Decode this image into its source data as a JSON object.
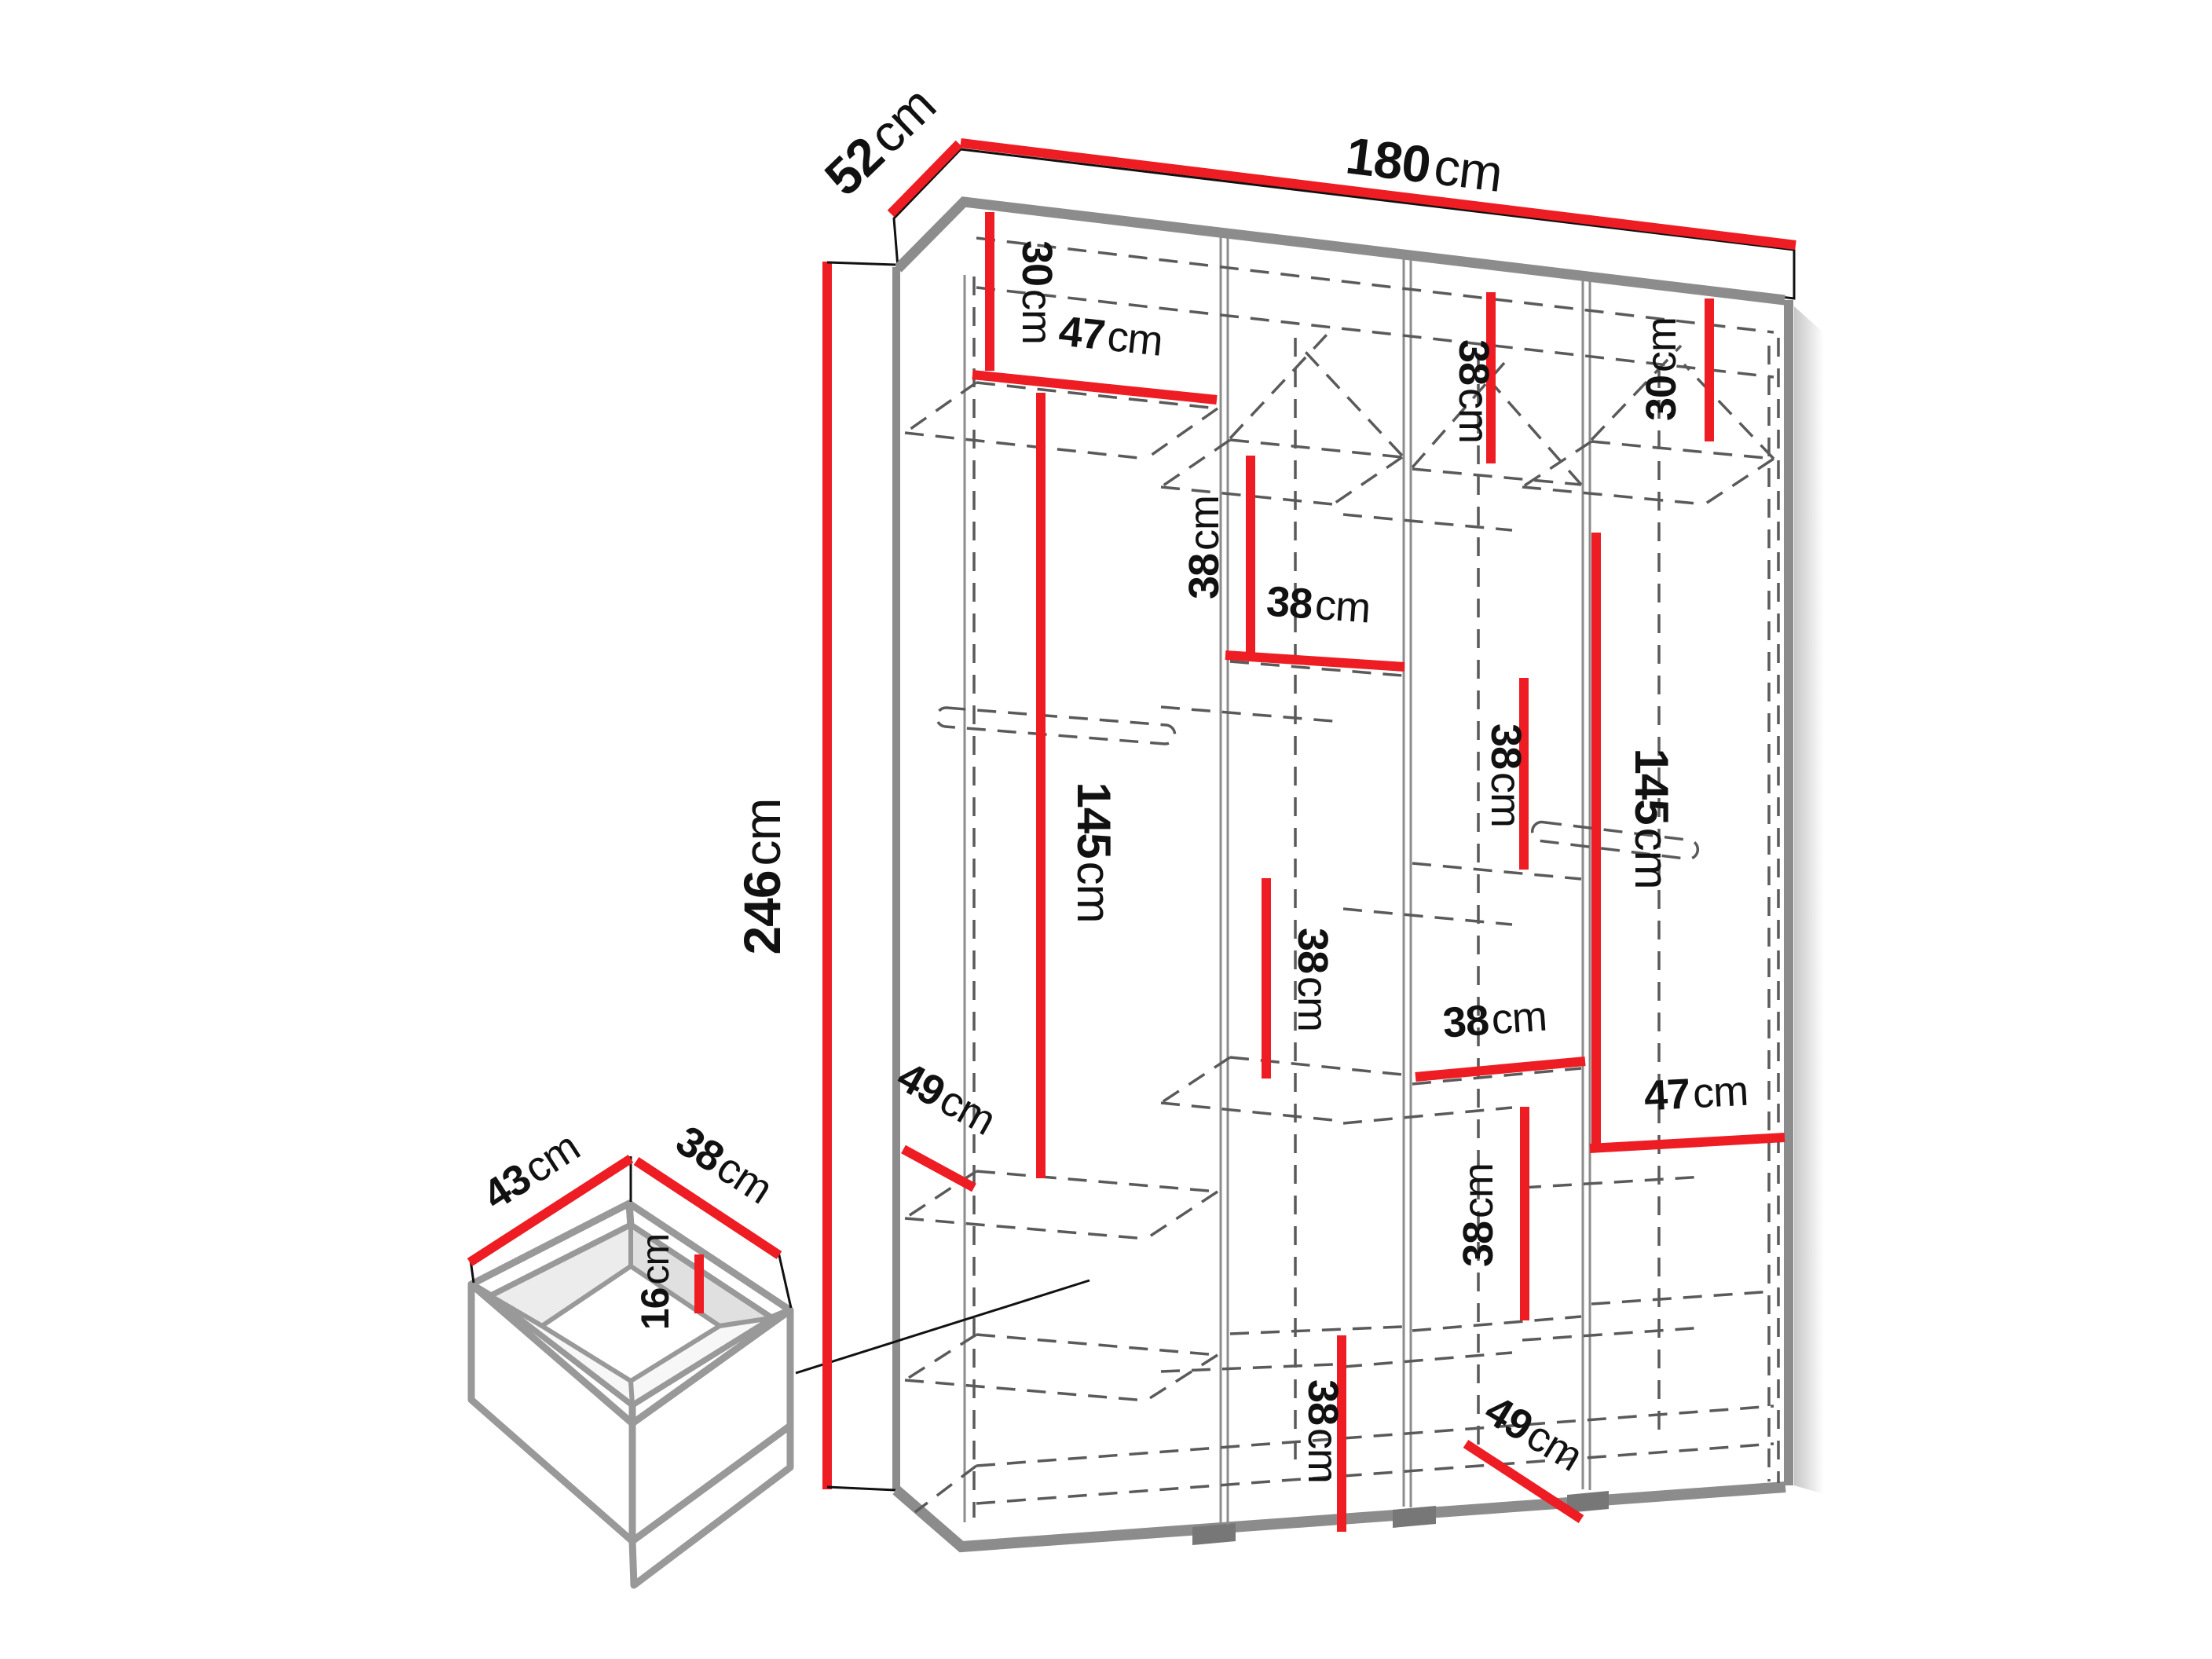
{
  "colors": {
    "dimension_red": "#ee1c23",
    "structure_gray": "#8c8c8c",
    "dash_gray": "#5a5a5a",
    "text_black": "#111111"
  },
  "wardrobe": {
    "width": {
      "value": "180",
      "unit": "cm"
    },
    "depth": {
      "value": "52",
      "unit": "cm"
    },
    "height": {
      "value": "246",
      "unit": "cm"
    },
    "col1": {
      "top_section": {
        "value": "30",
        "unit": "cm"
      },
      "shelf_width": {
        "value": "47",
        "unit": "cm"
      },
      "hanging_height": {
        "value": "145",
        "unit": "cm"
      },
      "shelf_depth": {
        "value": "49",
        "unit": "cm"
      }
    },
    "col2": {
      "upper_section": {
        "value": "38",
        "unit": "cm"
      },
      "shelf_width": {
        "value": "38",
        "unit": "cm"
      },
      "middle_section": {
        "value": "38",
        "unit": "cm"
      },
      "bottom_section": {
        "value": "38",
        "unit": "cm"
      }
    },
    "col3": {
      "top_section": {
        "value": "38",
        "unit": "cm"
      },
      "middle_section": {
        "value": "38",
        "unit": "cm"
      },
      "shelf_width": {
        "value": "38",
        "unit": "cm"
      },
      "lower_section": {
        "value": "38",
        "unit": "cm"
      },
      "shelf_depth": {
        "value": "49",
        "unit": "cm"
      }
    },
    "col4": {
      "top_section": {
        "value": "30",
        "unit": "cm"
      },
      "hanging_height": {
        "value": "145",
        "unit": "cm"
      },
      "shelf_width": {
        "value": "47",
        "unit": "cm"
      }
    }
  },
  "drawer": {
    "width": {
      "value": "43",
      "unit": "cm"
    },
    "depth": {
      "value": "38",
      "unit": "cm"
    },
    "height": {
      "value": "16",
      "unit": "cm"
    }
  }
}
